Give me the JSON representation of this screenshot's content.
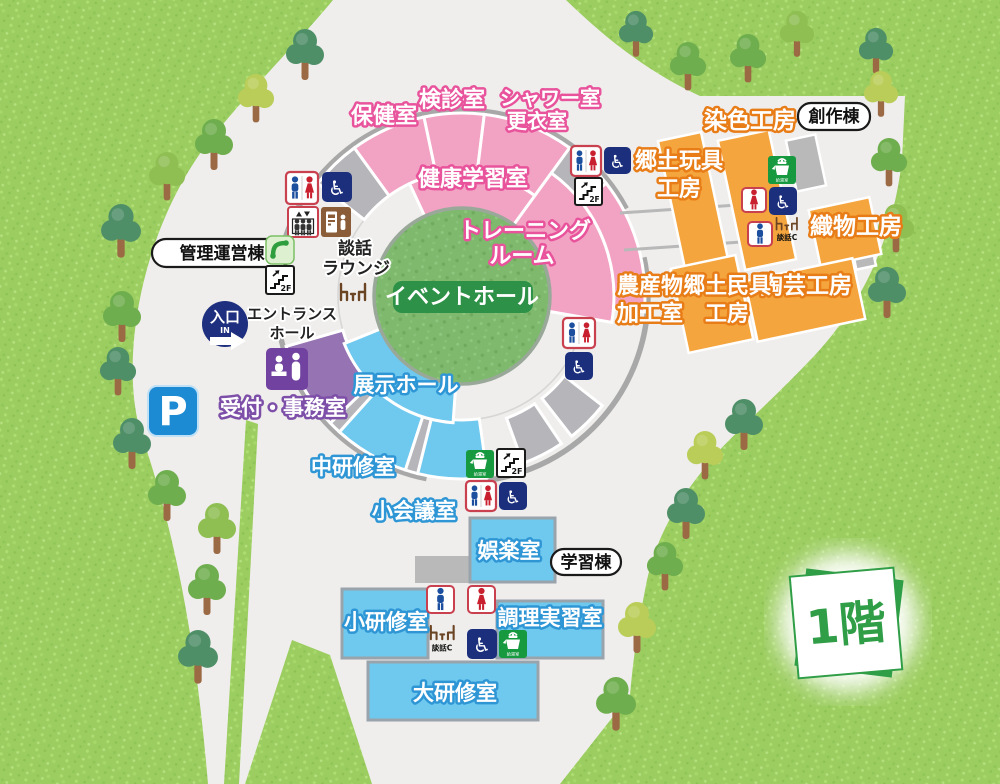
{
  "floor_badge": "1階",
  "buildings": {
    "management": "管理運営棟",
    "craft": "創作棟",
    "learning": "学習棟"
  },
  "rooms": {
    "hokenshitsu": "保健室",
    "kenshin": "検診室",
    "shower1": "シャワー室",
    "shower2": "更衣室",
    "kenko_gakushu": "健康学習室",
    "training1": "トレーニング",
    "training2": "ルーム",
    "event_hall": "イベントホール",
    "danwa1": "談話",
    "danwa2": "ラウンジ",
    "entrance_hall1": "エントランス",
    "entrance_hall2": "ホール",
    "reception": "受付・事務室",
    "exhibition": "展示ホール",
    "chu_kenshu": "中研修室",
    "sho_kaigi": "小会議室",
    "goraku": "娯楽室",
    "sho_kenshu": "小研修室",
    "chori": "調理実習室",
    "dai_kenshu": "大研修室",
    "senshoku": "染色工房",
    "gangu1": "郷土玩具",
    "gangu2": "工房",
    "orimono": "織物工房",
    "togei": "陶芸工房",
    "mingu1": "郷土民具",
    "mingu2": "工房",
    "nosan1": "農産物",
    "nosan2": "加工室"
  },
  "entrance": {
    "label": "入口",
    "sub": "IN"
  },
  "parking": "P",
  "icons": {
    "stairs_floor": "2F",
    "lounge_corner": "談話C",
    "hot_water": "給湯室"
  },
  "colors": {
    "grass": "#9ccd60",
    "plaza": "#efeeec",
    "pink_room": "#f2a2c2",
    "orange_room": "#f5a53e",
    "blue_room": "#6fc8ee",
    "purple_room": "#9673b3",
    "event_green": "#7eb96e",
    "event_label_green": "#2d9147",
    "entrance_navy": "#1d2f7e",
    "parking_blue": "#1d8bd4",
    "floor_green": "#2f9e47"
  }
}
